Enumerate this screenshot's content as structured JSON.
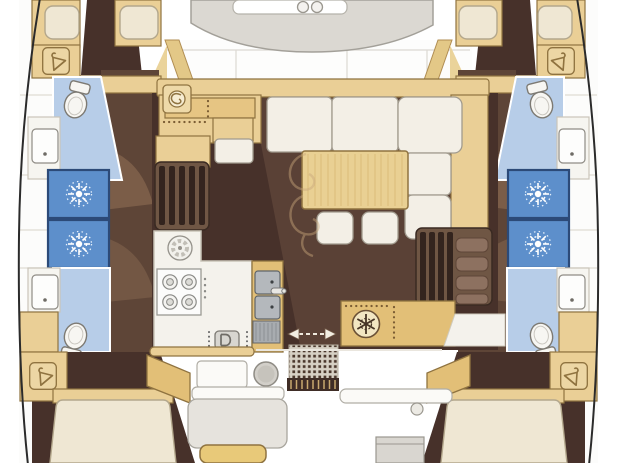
{
  "diagram": {
    "label": "Catamaran yacht interior floor plan, top-down view, bow at top",
    "type": "yacht-deck-floor-plan",
    "regions": [
      "foredeck seat with hatches",
      "saloon with L-settee, table and two stools",
      "chart table with instrument",
      "galley with stove, round sink, double sink, oven and refrigerator",
      "sliding door to aft cockpit",
      "cockpit with benches, tables and winches",
      "port hull: fore cabin, head, two showers, aft head, wardrobe, aft cabin",
      "starboard hull: fore cabin, head, two showers, aft head, wardrobe, aft cabin"
    ]
  },
  "colors": {
    "page_bg": "#ffffff",
    "floor_dark": "#47312a",
    "floor_mid": "#5e4537",
    "wood": "#eacf96",
    "wood_deep": "#e2bf77",
    "wood_border": "#8f7340",
    "cream": "#efe7d3",
    "cushion": "#f3efe6",
    "cushion_border": "#a19b8e",
    "wet_floor": "#b7cde8",
    "shower_blue": "#5d8fcb",
    "shower_frame": "#2c4a78",
    "fixture_white": "#f7f6f2",
    "fixture_border": "#7d7a73",
    "deck_gray": "#dbd8d2",
    "deck_line": "#a3a099",
    "appliance_gray": "#b4b8bc",
    "steel_gray": "#a8acb0",
    "grate_bg": "#d6d0c4",
    "grate_dot": "#4a372c",
    "hull_line": "#2b2b2b",
    "gold_table": "#e8c979",
    "shadow_wash": "#c8a37e",
    "star_white": "#ffffff",
    "snow_dark": "#463425"
  },
  "icons": [
    {
      "name": "hanger-icon",
      "meaning": "hanging locker / wardrobe",
      "count": 4
    },
    {
      "name": "toilet-icon",
      "meaning": "marine toilet",
      "count": 4
    },
    {
      "name": "washbasin-icon",
      "meaning": "bathroom sink",
      "count": 4
    },
    {
      "name": "shower-head-icon",
      "meaning": "shower stall",
      "count": 4
    },
    {
      "name": "stove-icon",
      "meaning": "4-burner galley stove",
      "count": 1
    },
    {
      "name": "round-sink-icon",
      "meaning": "round galley sink",
      "count": 1
    },
    {
      "name": "double-sink-icon",
      "meaning": "galley double sink with faucet",
      "count": 1
    },
    {
      "name": "oven-icon",
      "meaning": "built-in oven appliance",
      "count": 1
    },
    {
      "name": "fridge-snowflake-icon",
      "meaning": "refrigerator",
      "count": 1
    },
    {
      "name": "nav-instrument-icon",
      "meaning": "chart table instrument",
      "count": 1
    },
    {
      "name": "sliding-door-arrows-icon",
      "meaning": "sliding door travel direction",
      "count": 1
    },
    {
      "name": "deck-hatch-icon",
      "meaning": "foredeck hatch",
      "count": 2
    },
    {
      "name": "winch-icon",
      "meaning": "cockpit winch / pedestal",
      "count": 2
    }
  ]
}
